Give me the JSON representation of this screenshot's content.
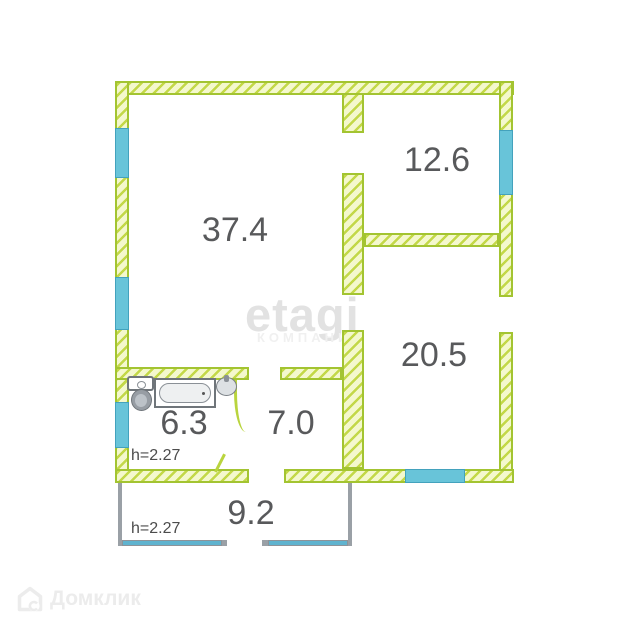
{
  "rooms": {
    "living": {
      "area": "37.4"
    },
    "bedroom1": {
      "area": "12.6"
    },
    "bedroom2": {
      "area": "20.5"
    },
    "bathroom": {
      "area": "6.3",
      "height_note": "h=2.27"
    },
    "hall": {
      "area": "7.0"
    },
    "porch": {
      "area": "9.2",
      "height_note": "h=2.27"
    }
  },
  "watermark": {
    "brand": "etagi",
    "brand_sub": "КОМПАНИЯ",
    "footer_brand": "Домклик"
  },
  "colors": {
    "wall_stripe": "#c3d848",
    "wall_fill": "#f4f8cd",
    "wall_border": "#a3c431",
    "window": "#68c4d9",
    "window_border": "#43a2bd",
    "porch_wall": "#9aa0a6",
    "porch_window": "#5fb3cf",
    "label_text": "#58595b",
    "door": "#b9d43e"
  }
}
